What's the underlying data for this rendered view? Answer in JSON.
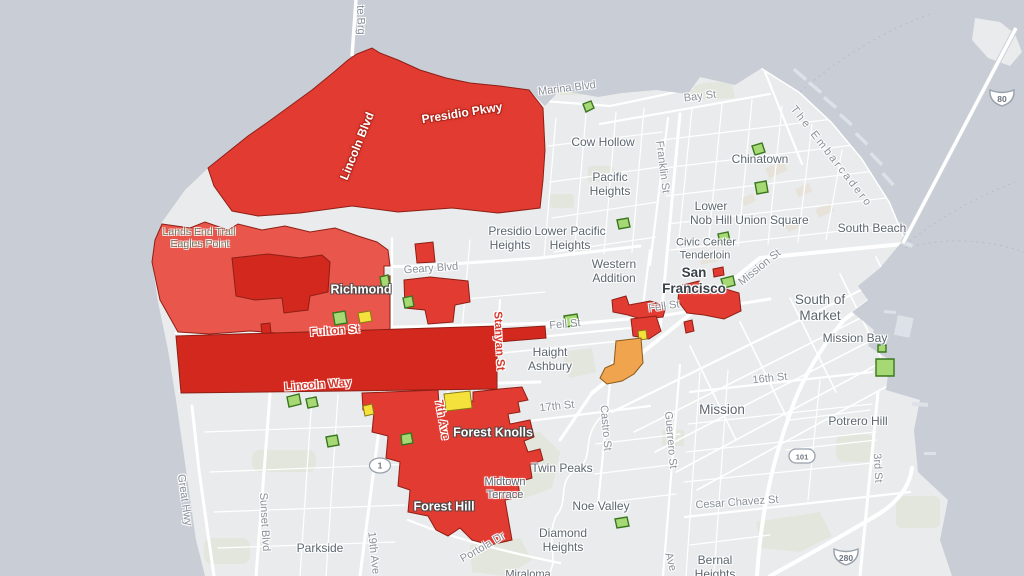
{
  "palette": {
    "land": "#e9ebec",
    "water": "#c8cdd6",
    "road": "#ffffff",
    "red": "#e23b32",
    "red_light": "#e8564c",
    "red_dark": "#d2281e",
    "orange": "#f0a44e",
    "yellow": "#f5e13c",
    "green": "#a6d974",
    "green_dark": "#39761f",
    "poly_stroke": "#8e1f15",
    "label": "#5d6770",
    "city": "#39414a",
    "road_label": "#8a9199",
    "road_label_red": "#d63a2e"
  },
  "map_labels": [
    {
      "id": "golden-gate-brg",
      "text": "te Brg",
      "x": 360,
      "y": 20,
      "rot": 88,
      "cls": "road-lb"
    },
    {
      "id": "marina-blvd",
      "text": "Marina Blvd",
      "x": 567,
      "y": 89,
      "rot": -7,
      "cls": "road-lb"
    },
    {
      "id": "bay-st",
      "text": "Bay St",
      "x": 700,
      "y": 97,
      "rot": -7,
      "cls": "road-lb"
    },
    {
      "id": "cow-hollow",
      "text": "Cow Hollow",
      "x": 603,
      "y": 142,
      "rot": 0,
      "cls": "place"
    },
    {
      "id": "chinatown",
      "text": "Chinatown",
      "x": 760,
      "y": 159,
      "rot": 0,
      "cls": "place"
    },
    {
      "id": "franklin-st",
      "text": "Franklin St",
      "x": 662,
      "y": 167,
      "rot": 83,
      "cls": "road-lb"
    },
    {
      "id": "pacific-heights",
      "text": "Pacific\nHeights",
      "x": 610,
      "y": 184,
      "rot": 0,
      "cls": "place"
    },
    {
      "id": "the-embarcadero",
      "text": "The Embarcadero",
      "x": 831,
      "y": 157,
      "rot": 52,
      "cls": "road-sp"
    },
    {
      "id": "lower-nob-hill",
      "text": "Lower\nNob Hill",
      "x": 711,
      "y": 213,
      "rot": 0,
      "cls": "place"
    },
    {
      "id": "union-square",
      "text": "Union Square",
      "x": 772,
      "y": 220,
      "rot": 0,
      "cls": "place"
    },
    {
      "id": "south-beach",
      "text": "South Beach",
      "x": 872,
      "y": 228,
      "rot": 0,
      "cls": "place"
    },
    {
      "id": "presidio-pkwy",
      "text": "Presidio Pkwy",
      "x": 462,
      "y": 113,
      "rot": -9,
      "cls": "road-white"
    },
    {
      "id": "lincoln-blvd",
      "text": "Lincoln Blvd",
      "x": 357,
      "y": 146,
      "rot": -68,
      "cls": "road-white"
    },
    {
      "id": "lands-end-trail",
      "text": "Lands End Trail",
      "x": 199,
      "y": 232,
      "rot": 0,
      "cls": "nature"
    },
    {
      "id": "eagles-point",
      "text": "Eagles Point",
      "x": 200,
      "y": 244,
      "rot": 0,
      "cls": "nature"
    },
    {
      "id": "presidio-heights",
      "text": "Presidio\nHeights",
      "x": 510,
      "y": 238,
      "rot": 0,
      "cls": "place"
    },
    {
      "id": "lower-pacific-heights",
      "text": "Lower Pacific\nHeights",
      "x": 570,
      "y": 238,
      "rot": 0,
      "cls": "place"
    },
    {
      "id": "western-addition",
      "text": "Western\nAddition",
      "x": 614,
      "y": 271,
      "rot": 0,
      "cls": "place"
    },
    {
      "id": "civic-center",
      "text": "Civic Center",
      "x": 706,
      "y": 243,
      "rot": 0,
      "cls": "place-sm"
    },
    {
      "id": "tenderloin",
      "text": "Tenderloin",
      "x": 705,
      "y": 256,
      "rot": 0,
      "cls": "place-sm"
    },
    {
      "id": "san-francisco",
      "text": "San\nFrancisco",
      "x": 694,
      "y": 281,
      "rot": 0,
      "cls": "city"
    },
    {
      "id": "geary-blvd",
      "text": "Geary Blvd",
      "x": 431,
      "y": 269,
      "rot": -4,
      "cls": "road-lb"
    },
    {
      "id": "richmond",
      "text": "Richmond",
      "x": 361,
      "y": 290,
      "rot": 0,
      "cls": "area"
    },
    {
      "id": "mission-st",
      "text": "Mission St",
      "x": 760,
      "y": 268,
      "rot": -39,
      "cls": "road-lb"
    },
    {
      "id": "south-of-market",
      "text": "South of\nMarket",
      "x": 820,
      "y": 308,
      "rot": 0,
      "cls": "place-lg"
    },
    {
      "id": "fell-st-west",
      "text": "Fell St",
      "x": 565,
      "y": 325,
      "rot": -5,
      "cls": "road-lb"
    },
    {
      "id": "fell-st-east",
      "text": "Fell St",
      "x": 664,
      "y": 307,
      "rot": -8,
      "cls": "road-lb"
    },
    {
      "id": "fulton-st",
      "text": "Fulton St",
      "x": 335,
      "y": 332,
      "rot": -4,
      "cls": "road-red"
    },
    {
      "id": "mission-bay",
      "text": "Mission Bay",
      "x": 855,
      "y": 338,
      "rot": 0,
      "cls": "place"
    },
    {
      "id": "haight-ashbury",
      "text": "Haight\nAshbury",
      "x": 550,
      "y": 359,
      "rot": 0,
      "cls": "place"
    },
    {
      "id": "stanyan-st",
      "text": "Stanyan St",
      "x": 498,
      "y": 341,
      "rot": 87,
      "cls": "road-red"
    },
    {
      "id": "lincoln-way",
      "text": "Lincoln Way",
      "x": 318,
      "y": 386,
      "rot": -4,
      "cls": "road-red"
    },
    {
      "id": "sixteenth-st",
      "text": "16th St",
      "x": 770,
      "y": 379,
      "rot": -6,
      "cls": "road-lb"
    },
    {
      "id": "seventeenth-st",
      "text": "17th St",
      "x": 557,
      "y": 407,
      "rot": -6,
      "cls": "road-lb"
    },
    {
      "id": "castro-st",
      "text": "Castro St",
      "x": 605,
      "y": 428,
      "rot": 85,
      "cls": "road-lb"
    },
    {
      "id": "guerrero-st",
      "text": "Guerrero St",
      "x": 670,
      "y": 440,
      "rot": 85,
      "cls": "road-lb"
    },
    {
      "id": "mission",
      "text": "Mission",
      "x": 722,
      "y": 410,
      "rot": 0,
      "cls": "place-lg"
    },
    {
      "id": "potrero-hill",
      "text": "Potrero Hill",
      "x": 858,
      "y": 421,
      "rot": 0,
      "cls": "place"
    },
    {
      "id": "seventh-ave",
      "text": "7th Ave",
      "x": 441,
      "y": 420,
      "rot": 80,
      "cls": "road-red"
    },
    {
      "id": "forest-knolls",
      "text": "Forest Knolls",
      "x": 493,
      "y": 433,
      "rot": 0,
      "cls": "area"
    },
    {
      "id": "third-st",
      "text": "3rd St",
      "x": 877,
      "y": 468,
      "rot": 87,
      "cls": "road-lb"
    },
    {
      "id": "twin-peaks",
      "text": "Twin Peaks",
      "x": 562,
      "y": 468,
      "rot": 0,
      "cls": "place"
    },
    {
      "id": "noe-valley",
      "text": "Noe Valley",
      "x": 601,
      "y": 506,
      "rot": 0,
      "cls": "place"
    },
    {
      "id": "midtown-terrace",
      "text": "Midtown\nTerrace",
      "x": 505,
      "y": 489,
      "rot": 0,
      "cls": "place-sm"
    },
    {
      "id": "forest-hill",
      "text": "Forest Hill",
      "x": 444,
      "y": 507,
      "rot": 0,
      "cls": "area"
    },
    {
      "id": "diamond-heights",
      "text": "Diamond\nHeights",
      "x": 563,
      "y": 540,
      "rot": 0,
      "cls": "place"
    },
    {
      "id": "cesar-chavez-st",
      "text": "Cesar Chavez St",
      "x": 737,
      "y": 503,
      "rot": -4,
      "cls": "road-lb"
    },
    {
      "id": "bernal-heights",
      "text": "Bernal\nHeights",
      "x": 715,
      "y": 567,
      "rot": 0,
      "cls": "place"
    },
    {
      "id": "great-hwy",
      "text": "Great Hwy",
      "x": 184,
      "y": 500,
      "rot": 82,
      "cls": "road-lb"
    },
    {
      "id": "sunset-blvd",
      "text": "Sunset Blvd",
      "x": 264,
      "y": 522,
      "rot": 87,
      "cls": "road-lb"
    },
    {
      "id": "parkside",
      "text": "Parkside",
      "x": 320,
      "y": 548,
      "rot": 0,
      "cls": "place"
    },
    {
      "id": "nineteenth-ave",
      "text": "19th Ave",
      "x": 373,
      "y": 553,
      "rot": 84,
      "cls": "road-lb"
    },
    {
      "id": "portola-dr",
      "text": "Portola Dr",
      "x": 483,
      "y": 548,
      "rot": -30,
      "cls": "road-lb"
    },
    {
      "id": "miraloma",
      "text": "Miraloma",
      "x": 528,
      "y": 575,
      "rot": 0,
      "cls": "place-sm"
    },
    {
      "id": "san-jose-ave",
      "text": "Ave",
      "x": 670,
      "y": 562,
      "rot": 75,
      "cls": "road-lb"
    }
  ],
  "shields": [
    {
      "num": "80",
      "type": "interstate",
      "x": 987,
      "y": 85
    },
    {
      "num": "101",
      "type": "us",
      "x": 787,
      "y": 446
    },
    {
      "num": "280",
      "type": "interstate",
      "x": 831,
      "y": 544
    },
    {
      "num": "1",
      "type": "state",
      "x": 367,
      "y": 456
    }
  ]
}
